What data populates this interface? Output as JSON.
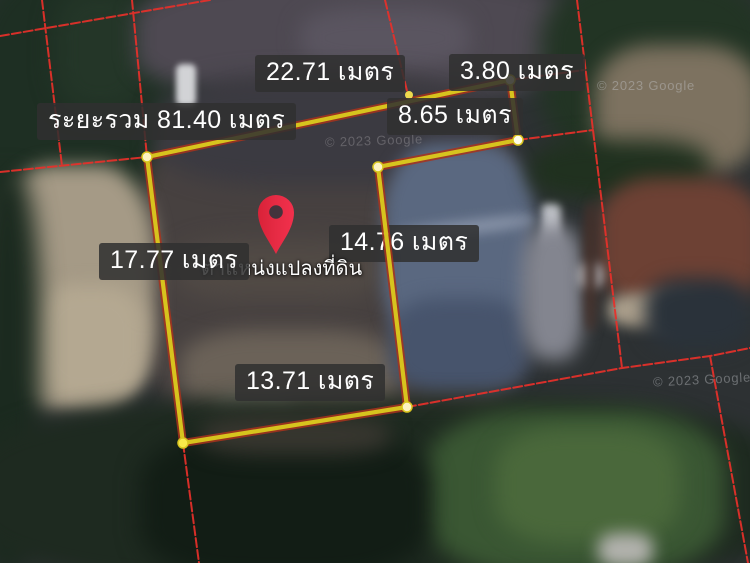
{
  "map_annotation": {
    "total_label": "ระยะรวม 81.40 เมตร",
    "total_meters": 81.4,
    "unit": "เมตร",
    "sides": [
      {
        "name": "top",
        "label": "22.71 เมตร",
        "meters": 22.71
      },
      {
        "name": "top-right",
        "label": "3.80 เมตร",
        "meters": 3.8
      },
      {
        "name": "notch-bottom",
        "label": "8.65 เมตร",
        "meters": 8.65
      },
      {
        "name": "right",
        "label": "14.76 เมตร",
        "meters": 14.76
      },
      {
        "name": "bottom",
        "label": "13.71 เมตร",
        "meters": 13.71
      },
      {
        "name": "left",
        "label": "17.77 เมตร",
        "meters": 17.77
      }
    ],
    "pin_caption": "ตำแหน่งแปลงที่ดิน"
  },
  "watermarks": [
    "© 2023 Google",
    "© 2023 Google",
    "© 2023 Google"
  ],
  "colors": {
    "plot_outline_yellow": "#d7c31e",
    "plot_outline_red_edge": "#a8321c",
    "cadastral_line_red": "#e8302a",
    "pin_red": "#e62b44",
    "label_background": "rgba(48,48,48,0.86)",
    "label_text": "#ffffff"
  }
}
